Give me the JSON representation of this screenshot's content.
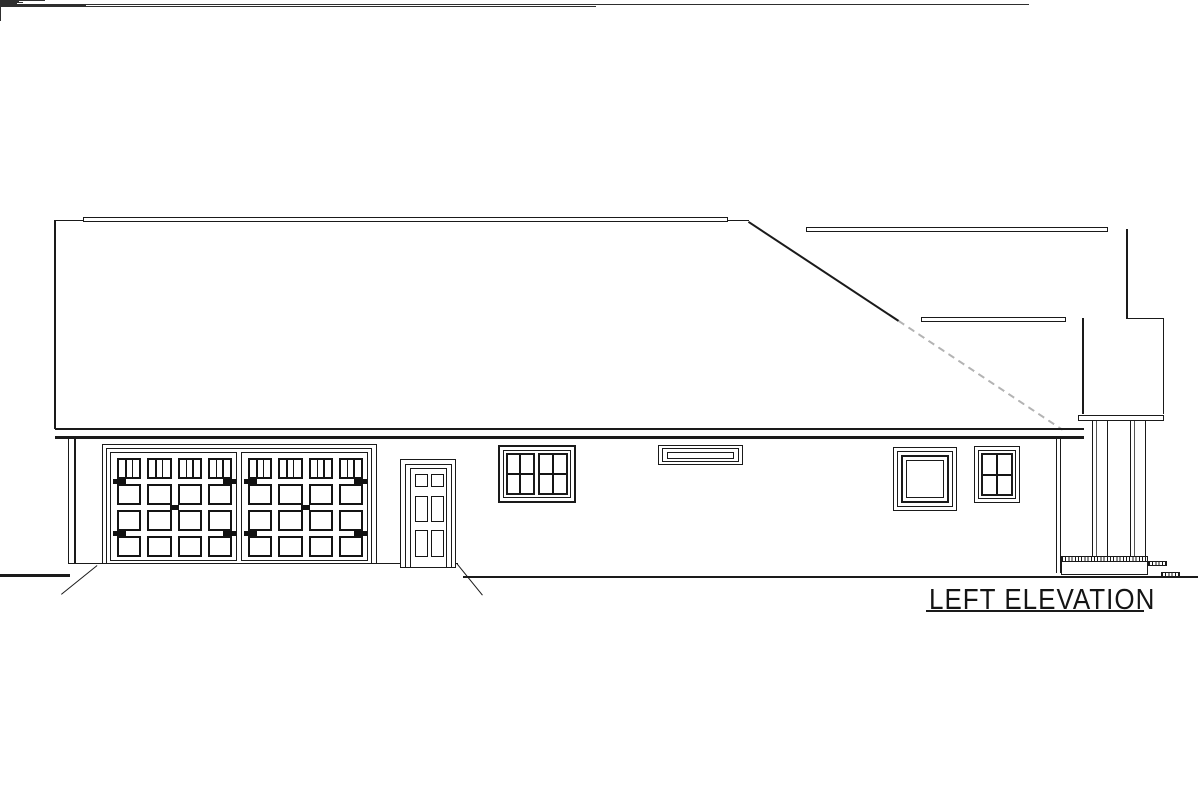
{
  "title": {
    "label": "LEFT ELEVATION"
  },
  "colors": {
    "line": "#1a1a1a",
    "panel_line": "#141414",
    "hidden_roof_line": "#b3b3b3",
    "paper": "#ffffff"
  },
  "garage": {
    "doors": [
      {
        "name": "garage-door-left",
        "panel_columns": 4,
        "panel_rows": 4,
        "top_row_panes_per_panel": 3,
        "hinge_marks": 4,
        "handle_marks": 1
      },
      {
        "name": "garage-door-right",
        "panel_columns": 4,
        "panel_rows": 4,
        "top_row_panes_per_panel": 3,
        "hinge_marks": 4,
        "handle_marks": 1
      }
    ]
  },
  "entry_door": {
    "name": "side-entry-door",
    "panel_columns": 2,
    "panel_rows": 3
  },
  "windows": [
    {
      "name": "double-window",
      "sashes": 2,
      "panes_per_sash": "2x2"
    },
    {
      "name": "transom-window",
      "sashes": 1,
      "panes_per_sash": "1x1"
    },
    {
      "name": "picture-window",
      "sashes": 1,
      "panes_per_sash": "1x1"
    },
    {
      "name": "single-window",
      "sashes": 1,
      "panes_per_sash": "2x2"
    }
  ],
  "porch": {
    "column_count": 2,
    "step_count": 2
  }
}
